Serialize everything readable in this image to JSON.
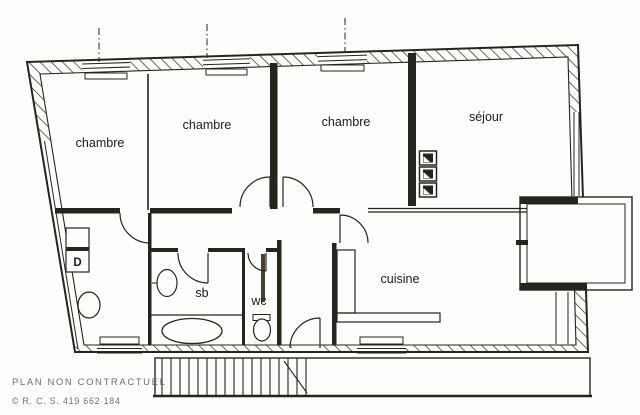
{
  "plan": {
    "type": "apartment-floor-plan",
    "rooms": [
      {
        "id": "chambre-1",
        "label": "chambre"
      },
      {
        "id": "chambre-2",
        "label": "chambre"
      },
      {
        "id": "chambre-3",
        "label": "chambre"
      },
      {
        "id": "sejour",
        "label": "séjour"
      },
      {
        "id": "cuisine",
        "label": "cuisine"
      },
      {
        "id": "salle-de-bains",
        "label": "sb"
      },
      {
        "id": "wc",
        "label": "wc"
      },
      {
        "id": "placard",
        "label": "D"
      }
    ],
    "fixtures": [
      "bathtub",
      "sink",
      "toilet",
      "staircase",
      "balcony",
      "kitchen-counter",
      "wall-unit-symbols"
    ]
  },
  "footer": {
    "disclaimer": "PLAN NON CONTRACTUEL",
    "registration": "© R. C. S. 419 662 184"
  },
  "colors": {
    "ink": "#26241f",
    "paper": "#fdfdfb",
    "label": "#1c1c1c",
    "footer": "#6f6f6f"
  }
}
